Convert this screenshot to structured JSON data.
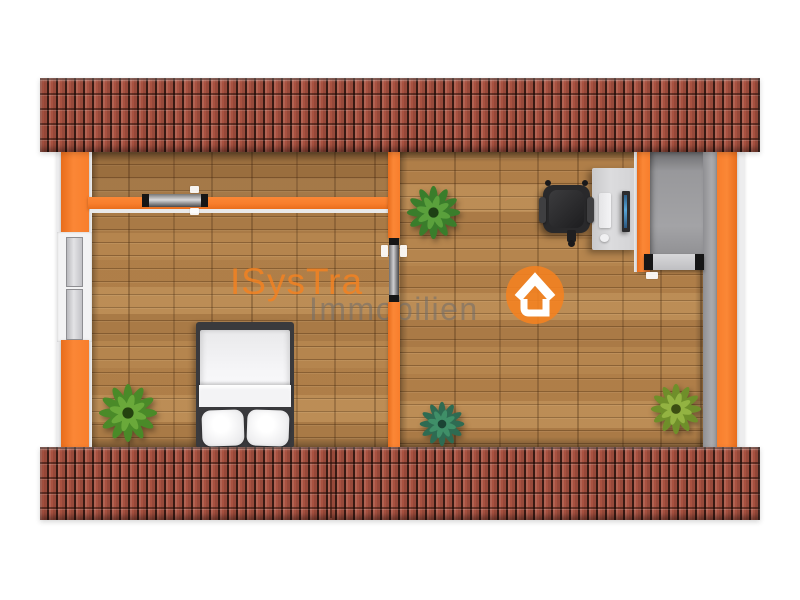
{
  "watermark": {
    "brand": "ISysTra",
    "subtitle": "Immobilien",
    "brand_color": "#F58220",
    "subtitle_color": "#6E6E6E",
    "logo_icon": "house-in-circle-icon"
  },
  "scene": {
    "type": "3d-floorplan-top-down-view",
    "rooms": [
      {
        "name": "bedroom-left",
        "items": [
          "double-bed",
          "potted-plant",
          "window",
          "sliding-door",
          "hallway"
        ]
      },
      {
        "name": "office-right",
        "items": [
          "desk",
          "office-chair",
          "monitor",
          "keyboard",
          "mouse",
          "staircase",
          "potted-plant",
          "potted-plant",
          "potted-plant"
        ]
      }
    ],
    "colors": {
      "wall_accent": "#F87E2C",
      "roof_tile": "#A85140",
      "floor_wood": "#B5854E",
      "stair_gray": "#9A9A9C",
      "background": "#FFFFFF"
    }
  }
}
